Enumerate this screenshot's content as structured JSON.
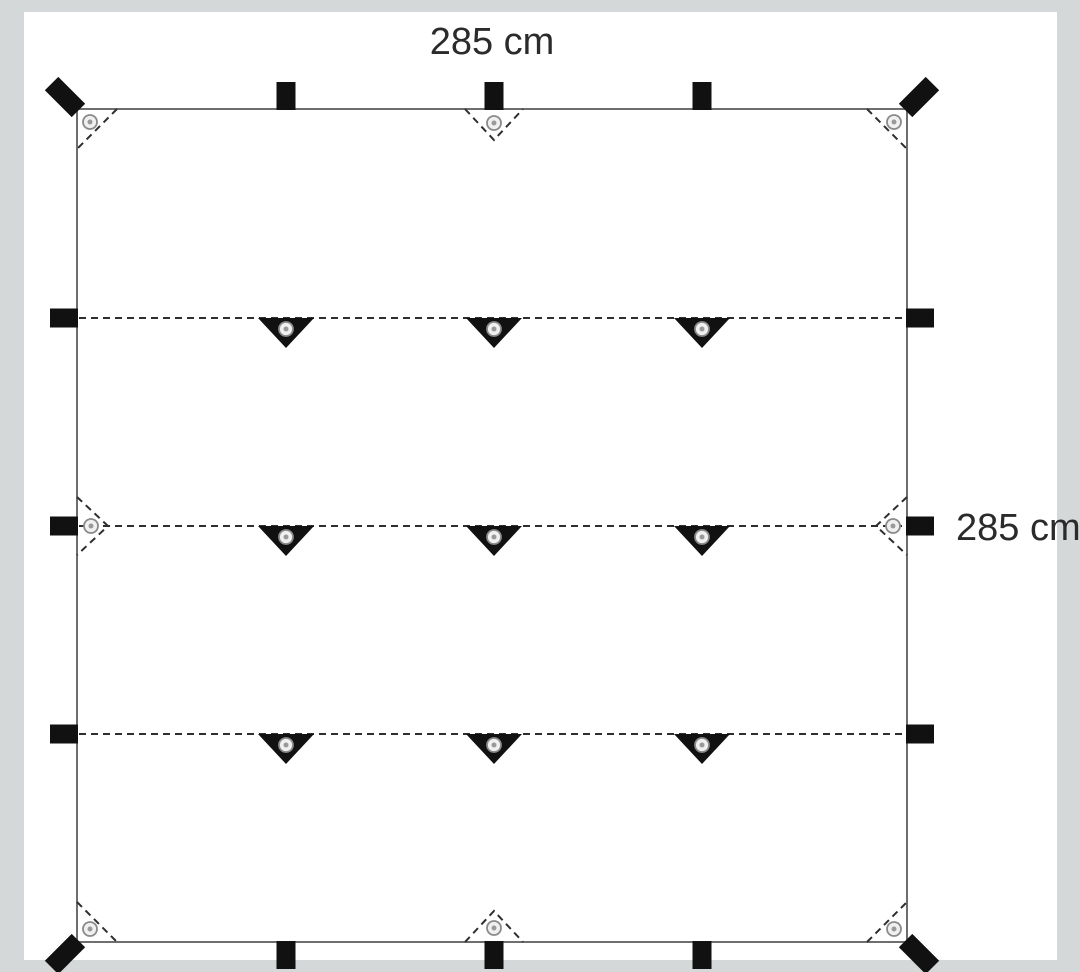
{
  "labels": {
    "width": "285 cm",
    "height": "285 cm"
  },
  "colors": {
    "background": "#d4d8d8",
    "canvas": "#ffffff",
    "tarp_fill": "#ffffff",
    "outline": "#6e6e6e",
    "hardware": "#111111",
    "dash": "#2e2e2e",
    "grommet_ring": "#8a8a8a",
    "grommet_fill": "#f0f0f0",
    "grommet_center": "#9a9a9a",
    "text": "#2b2b2b"
  },
  "diagram": {
    "kind": "tarp-top-view",
    "tarp": {
      "x": 53,
      "y": 97,
      "w": 830,
      "h": 833
    },
    "grid": {
      "fold_rows_y": [
        306,
        514,
        722
      ],
      "attachment_cols_x": [
        262,
        470,
        678
      ]
    },
    "edge_loop": {
      "w": 19,
      "l": 28
    },
    "corner_loop": {
      "w": 19,
      "l": 38,
      "offset": 12
    },
    "attachment_triangle": {
      "w": 56,
      "h": 30
    },
    "edge_reinforcement": {
      "half_base": 29,
      "depth": 31
    },
    "corner_fold_inset": 40,
    "grommet": {
      "r": 7,
      "inner_r": 2.5,
      "corner_offset": 13,
      "edge_offset": 14,
      "triangle_offset": 11
    },
    "dash_pattern": "7 5",
    "counts": {
      "inner_attachment_points": 9,
      "edge_loops": 12,
      "corner_loops": 4,
      "grommets": 17,
      "fold_lines": 3
    }
  },
  "label_layout": {
    "top": {
      "cx": 468,
      "y": 10
    },
    "right": {
      "x": 932,
      "y": 496
    },
    "font_px": 38
  }
}
